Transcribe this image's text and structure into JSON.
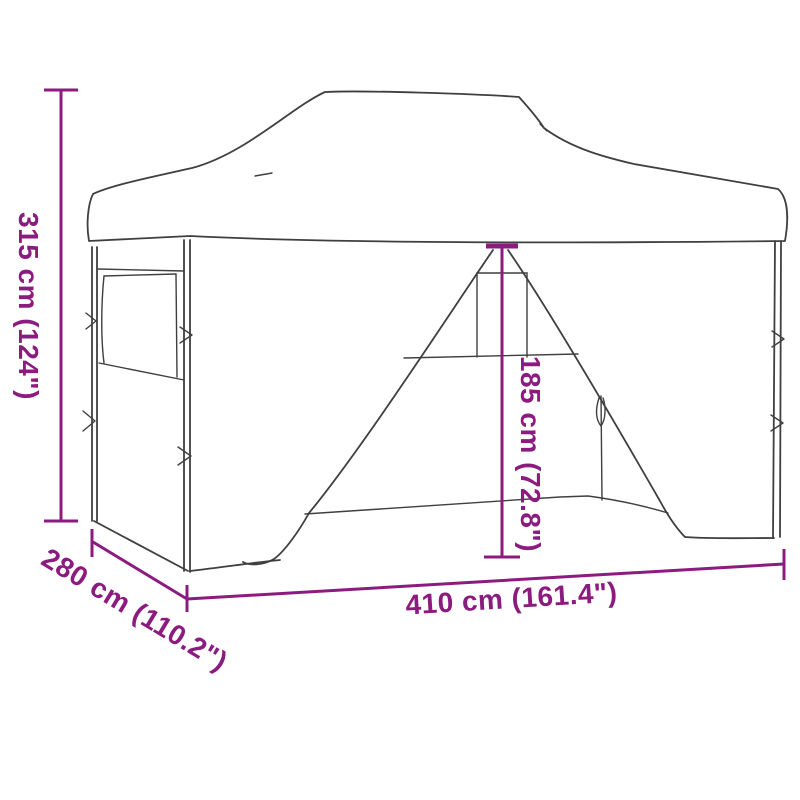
{
  "colors": {
    "dimension": "#8C1B7F",
    "line": "#3F3F3F",
    "background": "#FFFFFF"
  },
  "dimensions": {
    "height": "315 cm (124\")",
    "depth": "280 cm (110.2\")",
    "width": "410 cm (161.4\")",
    "door_height": "185 cm (72.8\")"
  }
}
